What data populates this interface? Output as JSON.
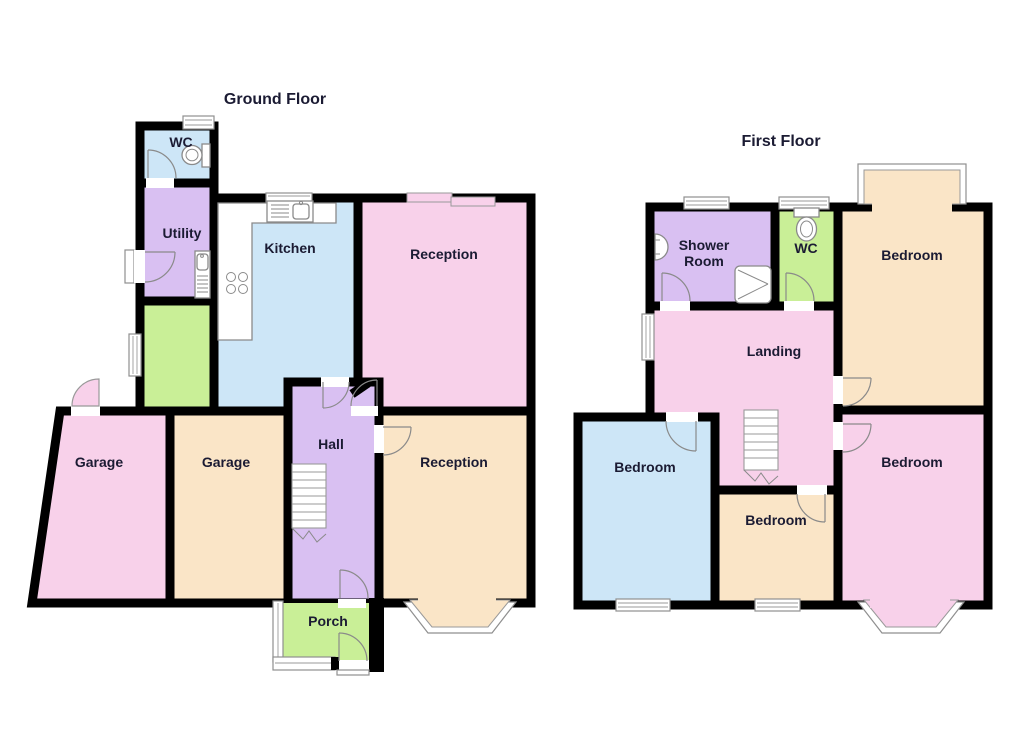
{
  "ground_floor": {
    "title": "Ground Floor",
    "rooms": {
      "wc": "WC",
      "utility": "Utility",
      "kitchen": "Kitchen",
      "reception_front": "Reception",
      "reception_rear": "Reception",
      "garage_left": "Garage",
      "garage_right": "Garage",
      "hall": "Hall",
      "porch": "Porch"
    }
  },
  "first_floor": {
    "title": "First Floor",
    "rooms": {
      "shower_room_line1": "Shower",
      "shower_room_line2": "Room",
      "wc": "WC",
      "bedroom_front": "Bedroom",
      "landing": "Landing",
      "bedroom_rear_left": "Bedroom",
      "bedroom_rear_middle": "Bedroom",
      "bedroom_rear_right": "Bedroom"
    }
  },
  "colors": {
    "wall": "#000000",
    "room_pink": "#f8d1ea",
    "room_cream": "#fae5c7",
    "room_blue": "#cde6f7",
    "room_lavender": "#d9c0f2",
    "room_green": "#c9ef97",
    "label_text": "#1b1b33",
    "window_fill": "#ffffff",
    "fixture_outline": "#8a8a8a"
  }
}
